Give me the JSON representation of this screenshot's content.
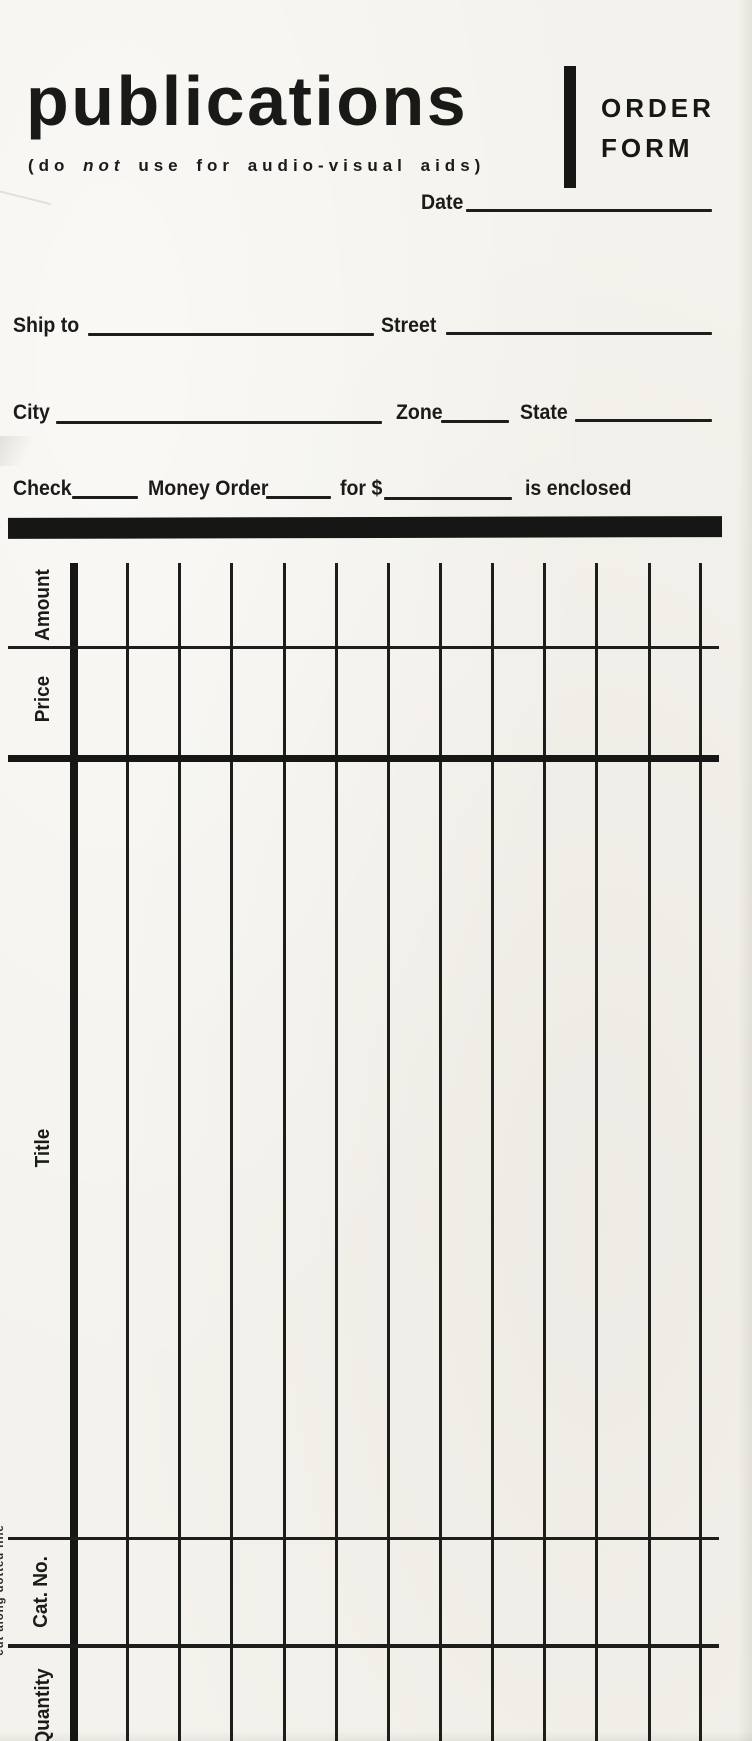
{
  "page": {
    "paper_color": "#f4f2ec",
    "ink_color": "#1b1b19"
  },
  "header": {
    "title": "publications",
    "subtitle": {
      "pre": "(do ",
      "italic": "not",
      "post": " use for audio-visual aids)"
    },
    "form_label": {
      "line1": "ORDER",
      "line2": "FORM"
    }
  },
  "fields": {
    "date": "Date",
    "ship_to": "Ship to",
    "street": "Street",
    "city": "City",
    "zone": "Zone",
    "state": "State",
    "check": "Check",
    "money_order": "Money Order",
    "for_amount": "for $",
    "is_enclosed": "is enclosed"
  },
  "table": {
    "column_labels": [
      "Amount",
      "Price",
      "Title",
      "Cat. No.",
      "Quantity"
    ],
    "entry_columns": 13
  },
  "edge_note": "cut along dotted line"
}
